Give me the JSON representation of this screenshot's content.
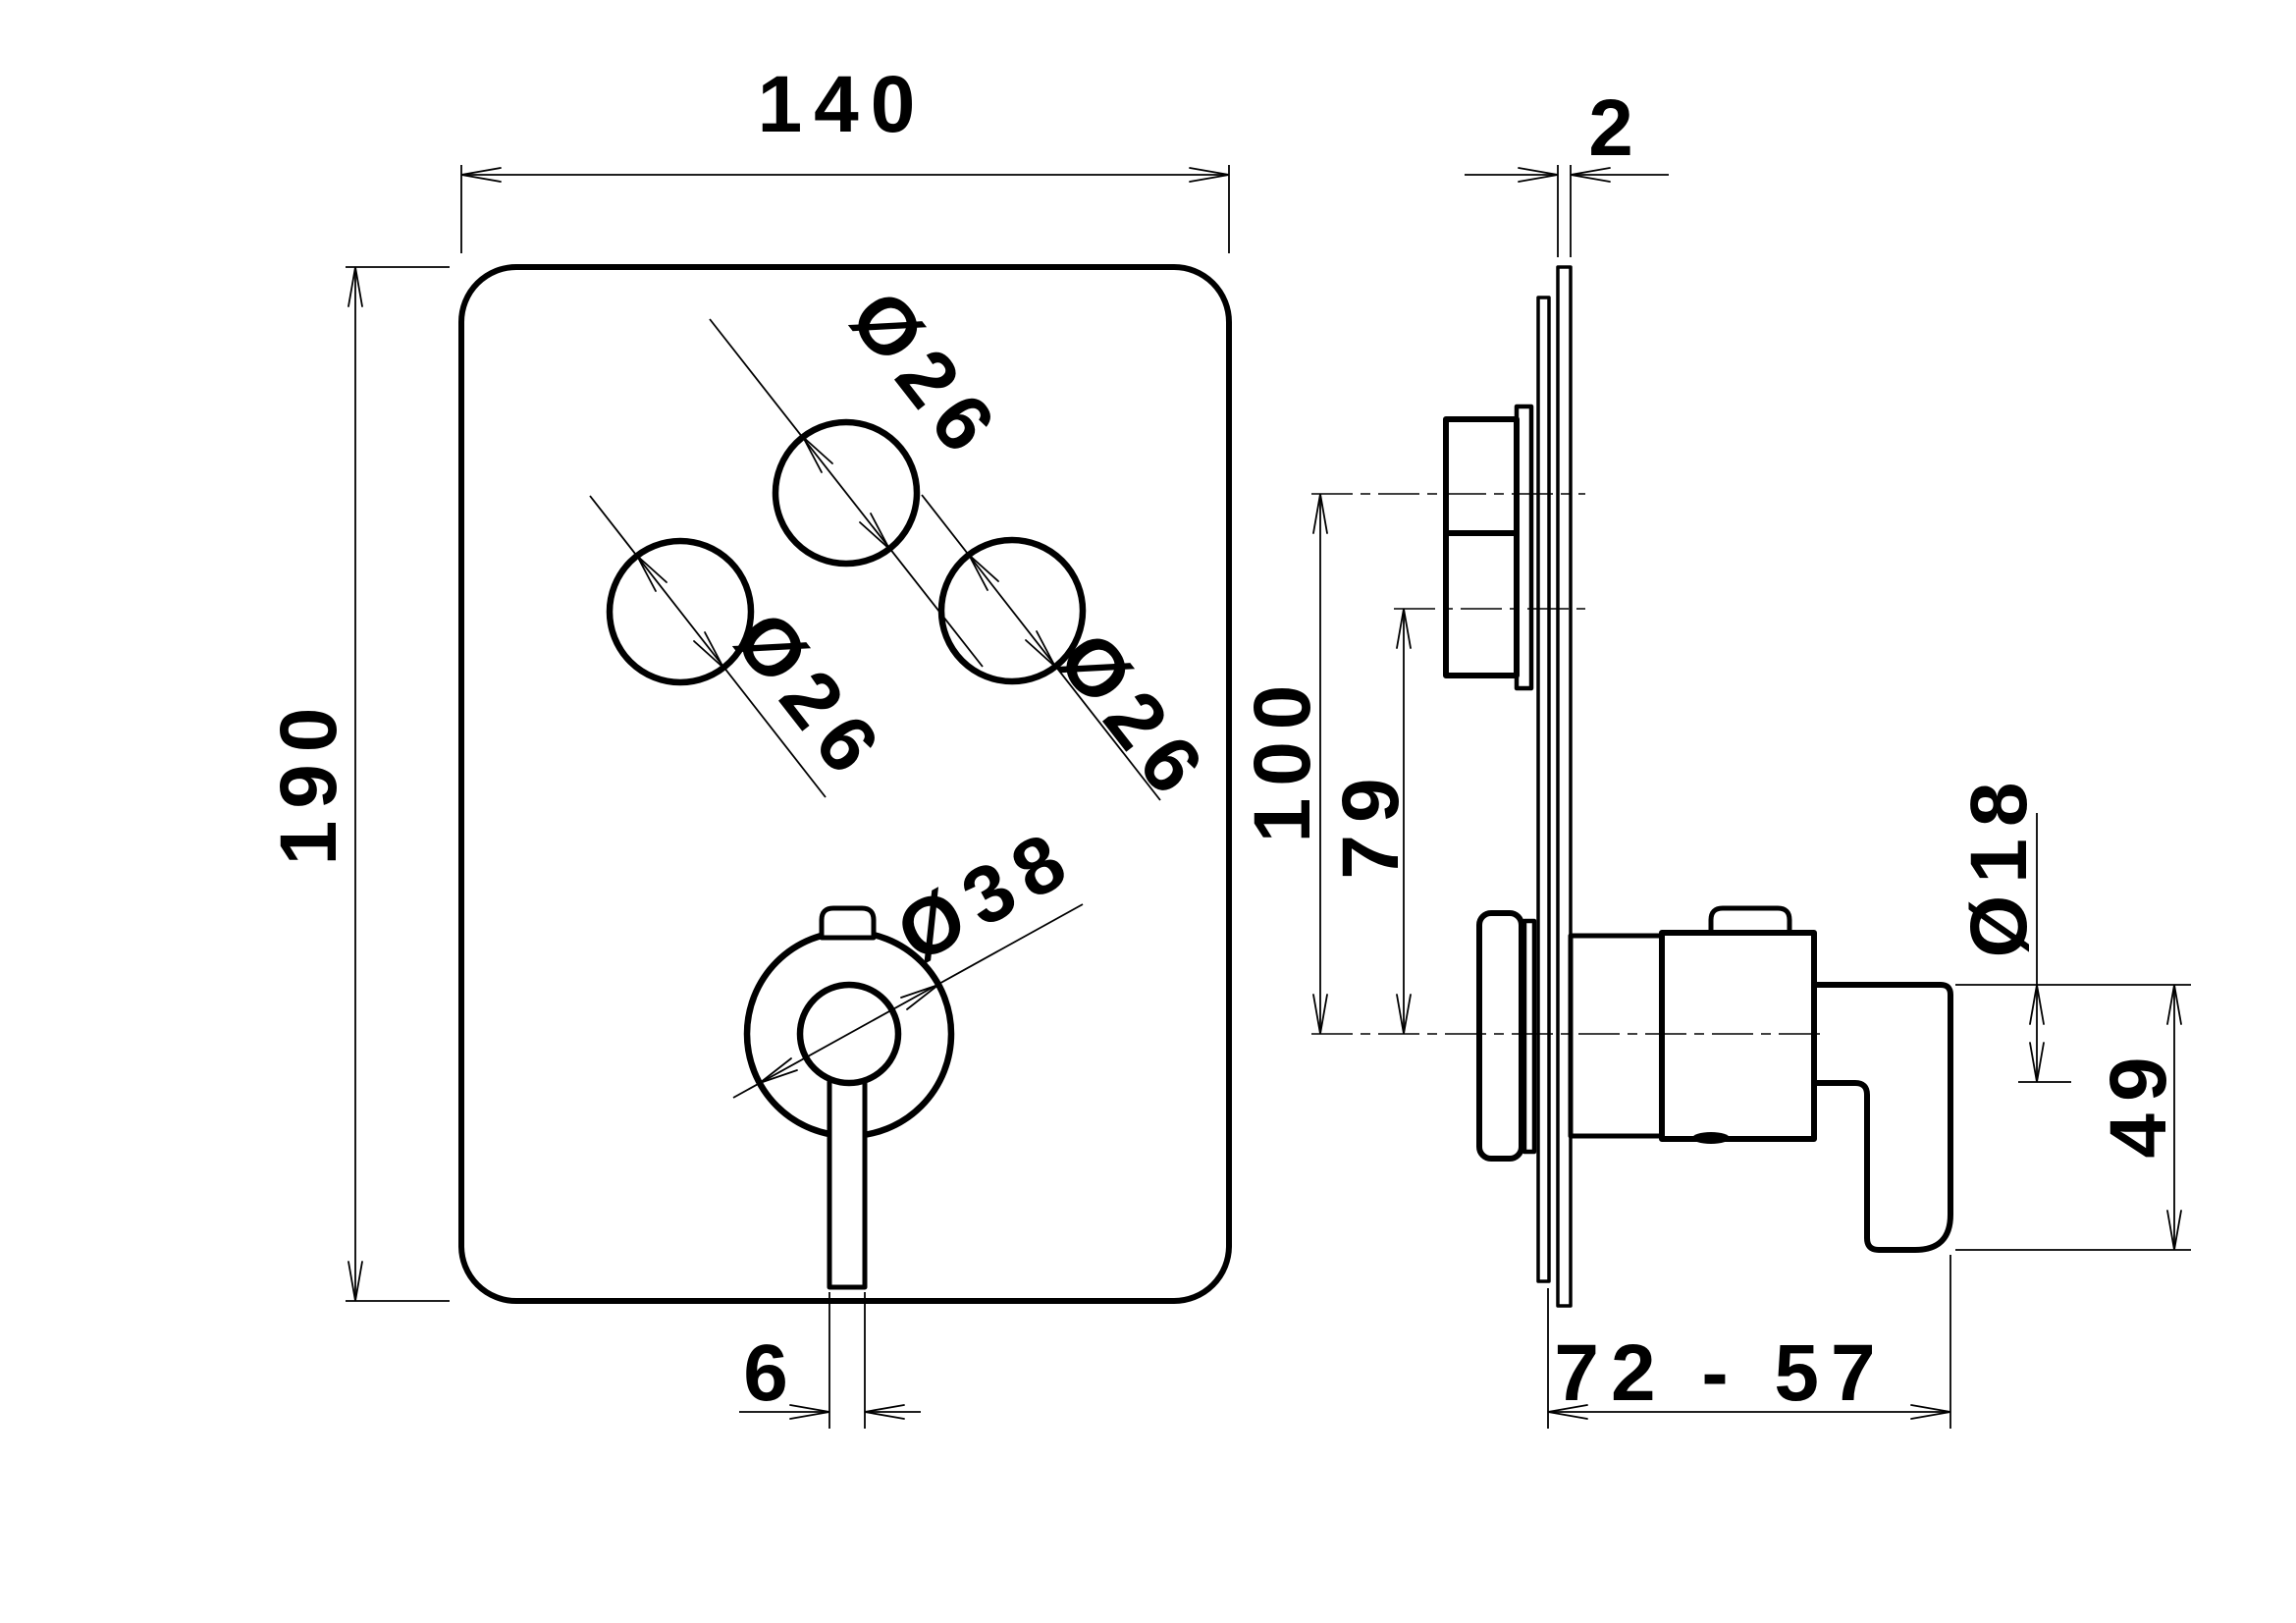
{
  "drawing": {
    "type": "technical-dimension-drawing",
    "subject": "concealed shower mixer trim plate, front and side views",
    "front_view": {
      "plate_width": "140",
      "plate_height": "190",
      "knob_top_diameter": "Ø26",
      "knob_left_diameter": "Ø26",
      "knob_right_diameter": "Ø26",
      "handle_rosette_diameter": "Ø38",
      "lever_stem_width": "6"
    },
    "side_view": {
      "plate_thickness": "2",
      "top_knob_axis_offset": "100",
      "side_knob_axis_offset": "79",
      "lever_bar_diameter": "Ø18",
      "lever_drop_length": "49",
      "projection_depth_range": "72 - 57"
    },
    "line_color": "#000000",
    "background_color": "#ffffff"
  }
}
